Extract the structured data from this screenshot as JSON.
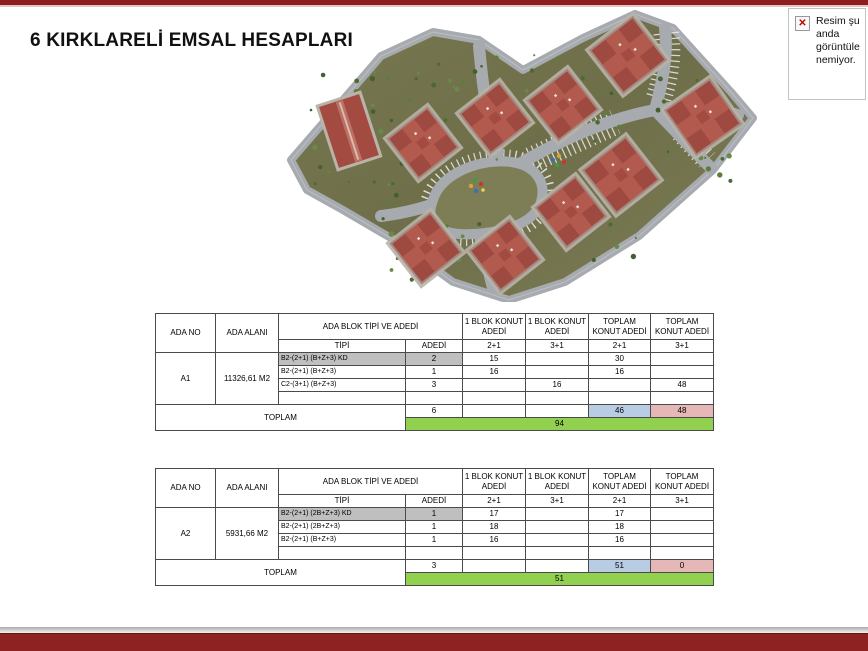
{
  "slide": {
    "title": "6 KIRKLARELİ EMSAL HESAPLARI",
    "accent_color": "#8e1e1e",
    "table_green": "#92d050",
    "table_blue": "#b8cce4",
    "table_pink": "#e5b8b7"
  },
  "broken_image": {
    "icon": "red-x-icon",
    "x_glyph": "✕",
    "lines": [
      "Resim şu",
      "anda",
      "görüntüle",
      "nemiyor."
    ]
  },
  "table_headers": {
    "ada_no": "ADA NO",
    "ada_alani": "ADA ALANI",
    "blok_tipi_ve_adedi": "ADA BLOK TİPİ VE ADEDİ",
    "tipi": "TİPİ",
    "adedi": "ADEDİ",
    "blok_konut_1": "1 BLOK KONUT ADEDİ",
    "blok_konut_2": "1 BLOK KONUT ADEDİ",
    "toplam_konut_1": "TOPLAM KONUT ADEDİ",
    "toplam_konut_2": "TOPLAM KONUT ADEDİ",
    "sub_21_a": "2+1",
    "sub_31_a": "3+1",
    "sub_21_b": "2+1",
    "sub_31_b": "3+1",
    "toplam": "TOPLAM"
  },
  "table1": {
    "ada_no": "A1",
    "ada_alani": "11326,61 M2",
    "rows": [
      {
        "tipi": "B2-(2+1) (B+Z+3) KD",
        "adedi": "2",
        "b21": "15",
        "b31": "",
        "t21": "30",
        "t31": ""
      },
      {
        "tipi": "B2-(2+1) (B+Z+3)",
        "adedi": "1",
        "b21": "16",
        "b31": "",
        "t21": "16",
        "t31": ""
      },
      {
        "tipi": "C2-(3+1) (B+Z+3)",
        "adedi": "3",
        "b21": "",
        "b31": "16",
        "t21": "",
        "t31": "48"
      },
      {
        "tipi": "",
        "adedi": "",
        "b21": "",
        "b31": "",
        "t21": "",
        "t31": ""
      }
    ],
    "toplam_adedi": "6",
    "toplam_b21": "",
    "toplam_b31": "",
    "toplam_21": "46",
    "toplam_31": "48",
    "genel_toplam": "94"
  },
  "table2": {
    "ada_no": "A2",
    "ada_alani": "5931,66 M2",
    "rows": [
      {
        "tipi": "B2-(2+1) (2B+Z+3) KD",
        "adedi": "1",
        "b21": "17",
        "b31": "",
        "t21": "17",
        "t31": ""
      },
      {
        "tipi": "B2-(2+1) (2B+Z+3)",
        "adedi": "1",
        "b21": "18",
        "b31": "",
        "t21": "18",
        "t31": ""
      },
      {
        "tipi": "B2-(2+1) (B+Z+3)",
        "adedi": "1",
        "b21": "16",
        "b31": "",
        "t21": "16",
        "t31": ""
      },
      {
        "tipi": "",
        "adedi": "",
        "b21": "",
        "b31": "",
        "t21": "",
        "t31": ""
      }
    ],
    "toplam_adedi": "3",
    "toplam_b21": "",
    "toplam_b31": "",
    "toplam_21": "51",
    "toplam_31": "0",
    "genel_toplam": "51"
  }
}
